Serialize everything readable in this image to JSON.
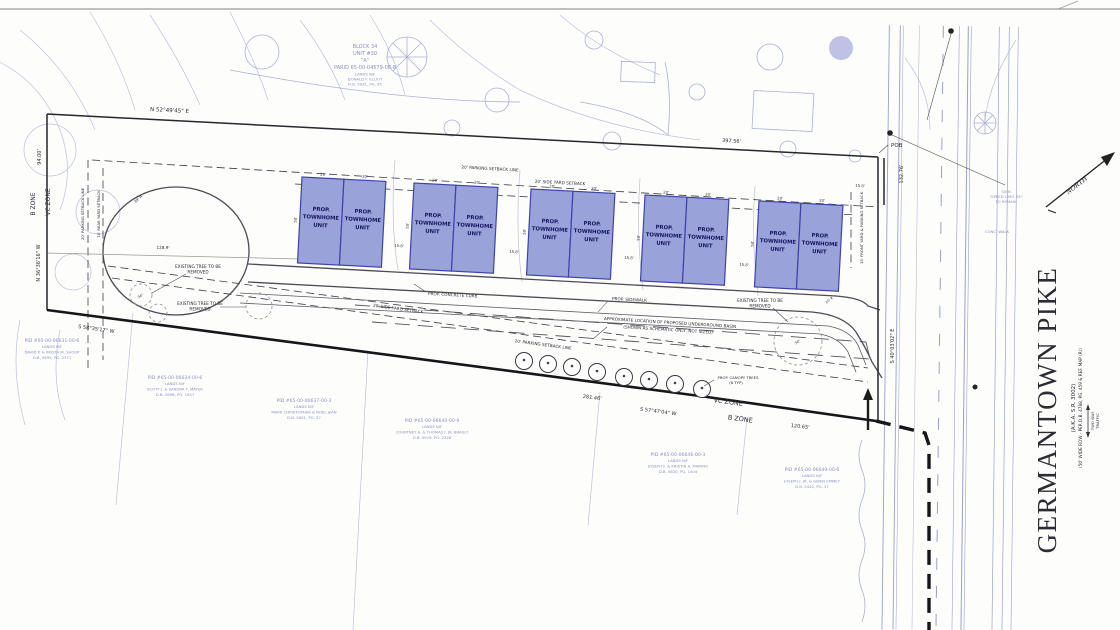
{
  "drawing": {
    "north_label": "NORTH",
    "pob": "POB"
  },
  "boundary": {
    "top_bearing": "N 52°49'45\" E",
    "top_length": "397.56'",
    "left_length": "94.00'",
    "left_bearing": "N 36°36'16\" W",
    "right_length": "132.76'",
    "right_road_bearing": "S 40°03'02\" E",
    "bottom_bearing_west": "S 58°35'17\" W",
    "bottom_length_mid": "281.46'",
    "bottom_bearing_east": "S 57°47'04\" W",
    "bottom_length_east": "120.65'"
  },
  "zones": {
    "b": "B ZONE",
    "vc": "VC ZONE"
  },
  "setbacks": {
    "parking_line": "20' PARKING SETBACK LINE",
    "side_yard": "20' SIDE YARD SETBACK",
    "rear_yard": "10' REAR YARD SETBACK",
    "front_yard": "15' FRONT YARD & PARKING SETBACK"
  },
  "units": {
    "line1": "PROP.",
    "line2": "TOWNHOME",
    "line3": "UNIT",
    "width": "20'",
    "depth": "50'",
    "gap": "15.8'"
  },
  "dims": {
    "bulb_width": "128.9'",
    "bulb_radius": "39' R",
    "exit_radius": "20' R",
    "front_gap": "15.8'"
  },
  "annotations": {
    "curb": "PROP. CONCRETE CURB",
    "sidewalk": "PROP. SIDEWALK",
    "basin1": "APPROXIMATE LOCATION OF PROPOSED UNDERGROUND BASIN",
    "basin2": "(SHOWN AS SCHEMATIC ONLY, NOT SIZED)",
    "tree_remove1": "EXISTING TREE TO BE",
    "tree_remove2": "REMOVED",
    "canopy1": "PROP. CANOPY TREES",
    "canopy2": "(8 TYP)",
    "tree_size": "34\""
  },
  "pike": {
    "name": "GERMANTOWN PIKE",
    "aka": "(A.K.A. S.R. 3002)",
    "row": "(50' WIDE ROW - PER D.B. 4788, PG. 459 & REF. MAP (R))",
    "traffic1": "TWO WAY",
    "traffic2": "TRAFFIC"
  },
  "roadside": {
    "sign1": "SIGN",
    "sign2": "\"SPEED LIMIT 35\"",
    "sign3": "TO REMAIN",
    "walk": "CONC. WALK"
  },
  "parcel": {
    "lines": [
      "BLOCK 34",
      "UNIT #30",
      "\"A\"",
      "PARID 65-00-04579-00-8",
      "LANDS N/F",
      "DONALD F. ELLIOT",
      "D.B. 5931, PG. 35"
    ]
  },
  "neighbors": [
    {
      "lines": [
        "PID #65-00-06631-00-6",
        "LANDS N/F",
        "DAVID P. & KRISTA M. SHOUP",
        "D.B. 5695, PG. 2371"
      ]
    },
    {
      "lines": [
        "PID #65-00-06634-00-6",
        "LANDS N/F",
        "SCOTT J. & SANDRA T. MAYER",
        "D.B. 5698, PG. 1557"
      ]
    },
    {
      "lines": [
        "PID #65-00-06637-00-3",
        "LANDS N/F",
        "MARK CHRISTOPHER & NOEL JEAN",
        "D.B. 5801, PG. 37"
      ]
    },
    {
      "lines": [
        "PID #65-00-06640-00-9",
        "LANDS N/F",
        "COURTNEY A. & THOMAS J. JR. BRAULT",
        "D.B. 5919, PG. 2328"
      ]
    },
    {
      "lines": [
        "PID #65-00-06646-00-3",
        "LANDS N/F",
        "JOSEPH F. & KRISTIN A. MARINO",
        "D.B. 5620, PG. 1404"
      ]
    },
    {
      "lines": [
        "PID #65-00-06649-00-6",
        "LANDS N/F",
        "JOSEPH J. JR. & GWEN EMMEY",
        "D.B. 5442, PG. 37"
      ]
    }
  ]
}
